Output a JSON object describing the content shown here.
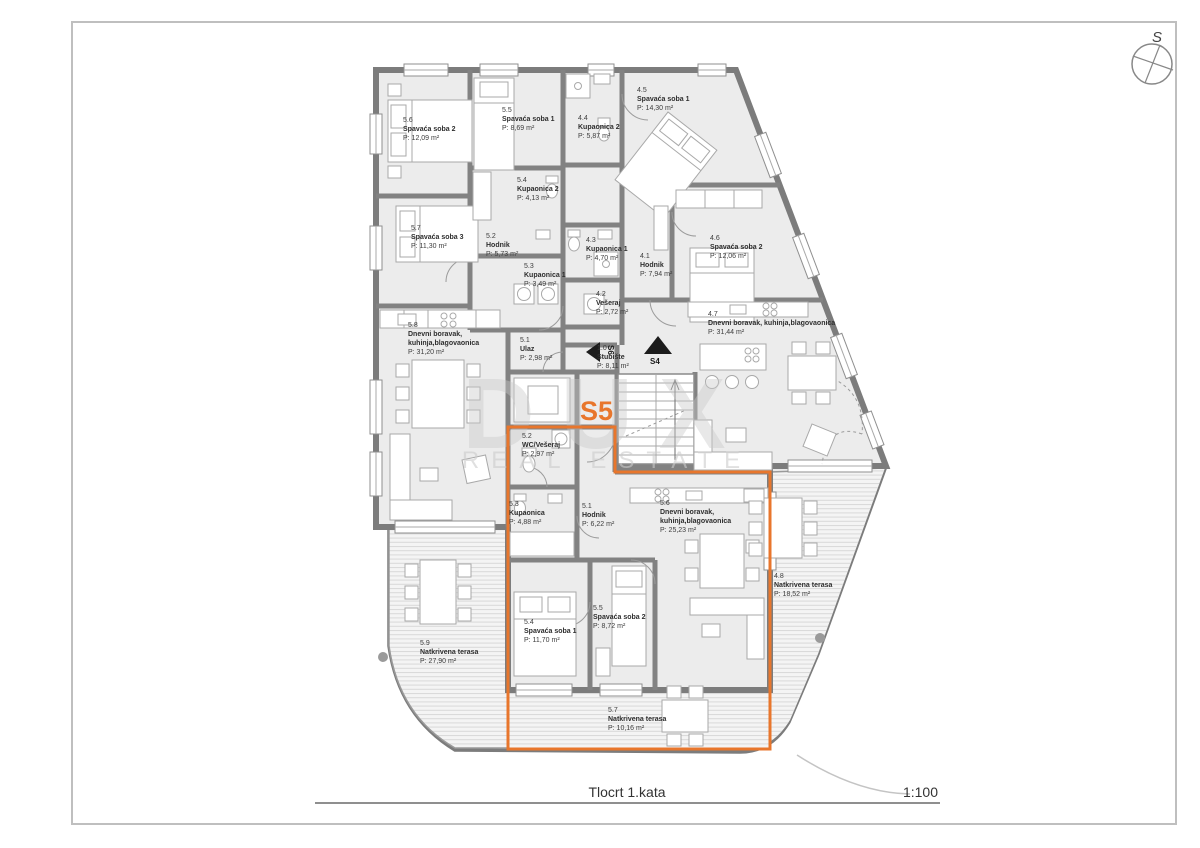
{
  "plan": {
    "title": "Tlocrt 1.kata",
    "scale": "1:100",
    "compass_label": "S",
    "highlighted_unit": "S5",
    "accent_color": "#e8762c",
    "stair_arrow_left": "S6",
    "stair_arrow_right": "S4",
    "watermark_line1": "DUX",
    "watermark_line2": "REAL ESTATE"
  },
  "rooms": [
    {
      "code": "5.6",
      "name": "Spavaća soba 2",
      "area": "P: 12,09 m²"
    },
    {
      "code": "5.5",
      "name": "Spavaća soba 1",
      "area": "P: 8,69 m²"
    },
    {
      "code": "4.4",
      "name": "Kupaonica 2",
      "area": "P: 5,87 m²"
    },
    {
      "code": "4.5",
      "name": "Spavaća soba 1",
      "area": "P: 14,30 m²"
    },
    {
      "code": "5.4",
      "name": "Kupaonica 2",
      "area": "P: 4,13 m²"
    },
    {
      "code": "5.7",
      "name": "Spavaća soba 3",
      "area": "P: 11,30 m²"
    },
    {
      "code": "5.2",
      "name": "Hodnik",
      "area": "P: 5,73 m²"
    },
    {
      "code": "4.3",
      "name": "Kupaonica 1",
      "area": "P: 4,70 m²"
    },
    {
      "code": "4.1",
      "name": "Hodnik",
      "area": "P: 7,94 m²"
    },
    {
      "code": "4.6",
      "name": "Spavaća soba 2",
      "area": "P: 12,06 m²"
    },
    {
      "code": "5.3",
      "name": "Kupaonica 1",
      "area": "P: 3,49 m²"
    },
    {
      "code": "4.2",
      "name": "Vešeraj",
      "area": "P: 2,72 m²"
    },
    {
      "code": "4.7",
      "name": "Dnevni boravak, kuhinja,blagovaonica",
      "area": "P: 31,44 m²"
    },
    {
      "code": "5.8",
      "name": "Dnevni boravak,",
      "name2": "kuhinja,blagovaonica",
      "area": "P: 31,20 m²"
    },
    {
      "code": "5.1",
      "name": "Ulaz",
      "area": "P: 2,98 m²"
    },
    {
      "code": "1.0",
      "name": "Stubište",
      "area": "P: 8,11 m²"
    },
    {
      "code": "5.2",
      "name": "WC/Vešeraj",
      "area": "P: 2,97 m²"
    },
    {
      "code": "5.3",
      "name": "Kupaonica",
      "area": "P: 4,88 m²"
    },
    {
      "code": "5.1",
      "name": "Hodnik",
      "area": "P: 6,22 m²"
    },
    {
      "code": "5.6",
      "name": "Dnevni boravak,",
      "name2": "kuhinja,blagovaonica",
      "area": "P: 25,23 m²"
    },
    {
      "code": "4.8",
      "name": "Natkrivena terasa",
      "area": "P: 18,52 m²"
    },
    {
      "code": "5.9",
      "name": "Natkrivena terasa",
      "area": "P: 27,90 m²"
    },
    {
      "code": "5.4",
      "name": "Spavaća soba 1",
      "area": "P: 11,70 m²"
    },
    {
      "code": "5.5",
      "name": "Spavaća soba 2",
      "area": "P: 8,72 m²"
    },
    {
      "code": "5.7",
      "name": "Natkrivena terasa",
      "area": "P: 10,16 m²"
    }
  ]
}
